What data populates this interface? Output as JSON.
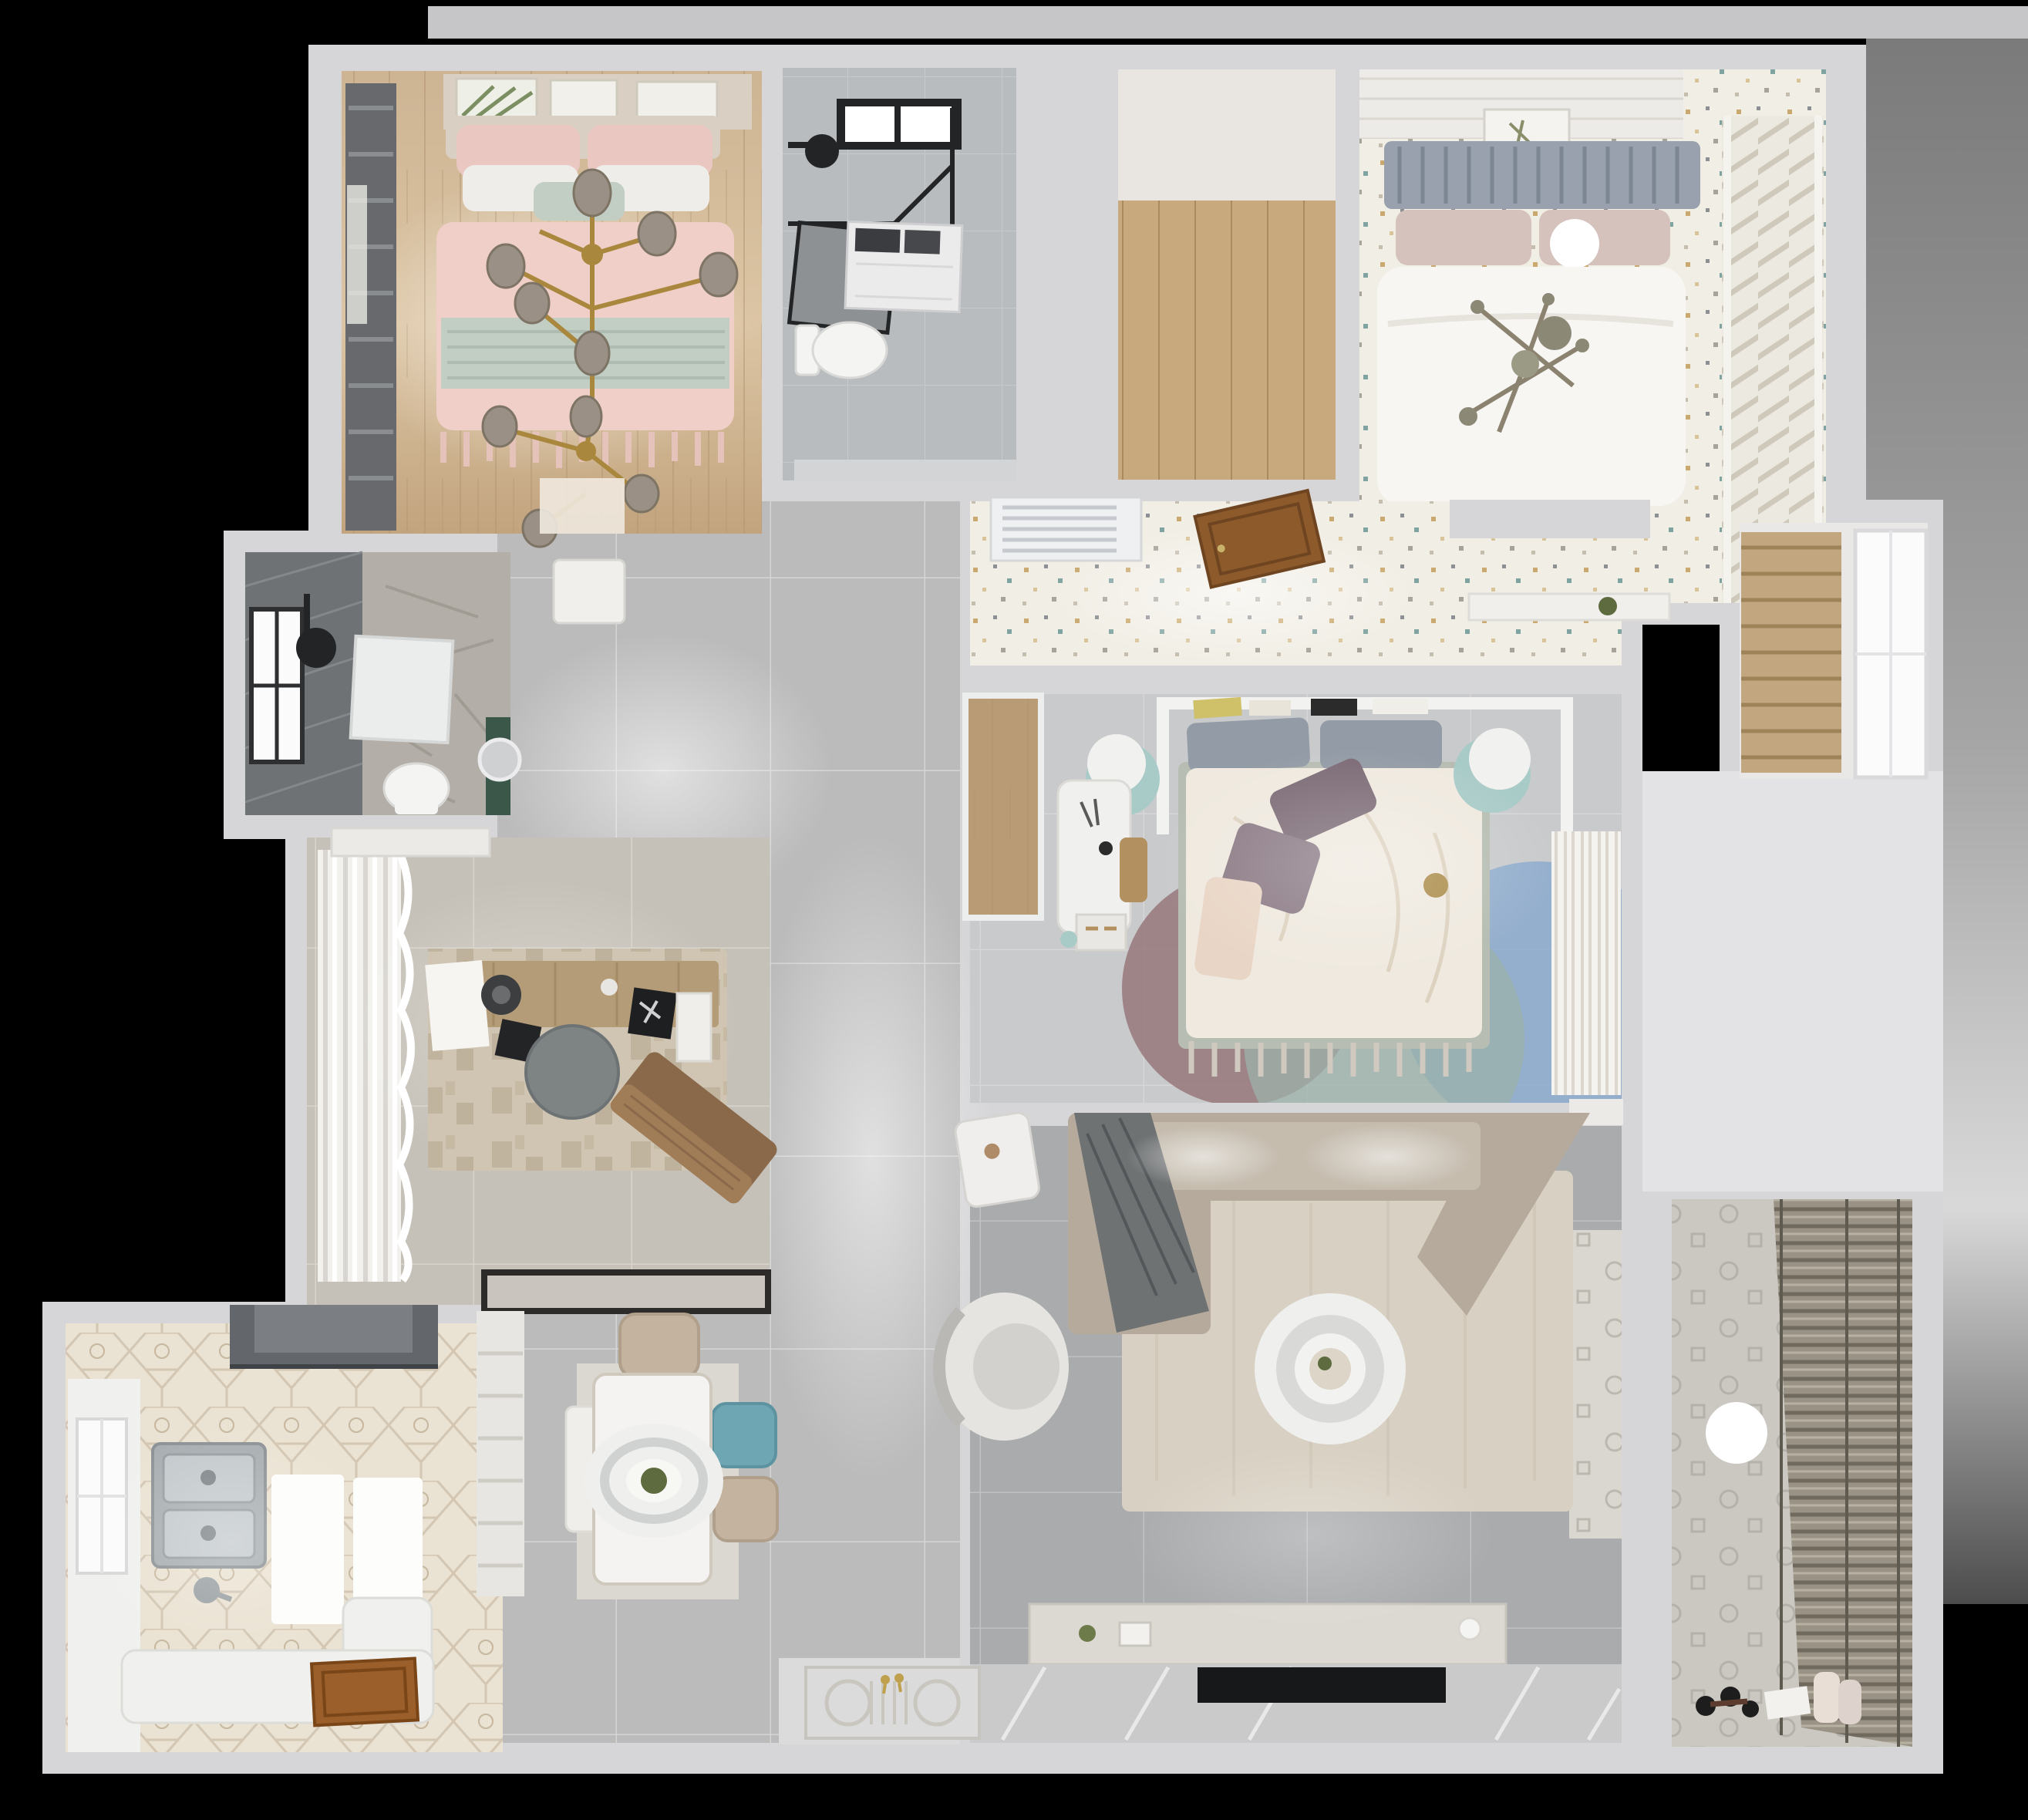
{
  "scene": {
    "type": "3d-floorplan-top-down-render",
    "rooms": [
      {
        "id": "bedroom-pink",
        "label": "bedroom-with-pink-bed"
      },
      {
        "id": "bathroom-top",
        "label": "bathroom-with-shower-and-washer"
      },
      {
        "id": "closet-room",
        "label": "empty-room-wood-floor"
      },
      {
        "id": "bedroom-white",
        "label": "bedroom-with-white-bed"
      },
      {
        "id": "dressing-corridor",
        "label": "corridor-with-ac-vent-and-open-door"
      },
      {
        "id": "master-bedroom",
        "label": "bedroom-with-desk-and-round-rug"
      },
      {
        "id": "bathroom-small",
        "label": "small-shower-room"
      },
      {
        "id": "study",
        "label": "study-with-desk-and-lounge-chair"
      },
      {
        "id": "kitchen",
        "label": "kitchen-hexagon-tile"
      },
      {
        "id": "dining",
        "label": "dining-area-with-pendant"
      },
      {
        "id": "living",
        "label": "living-room-with-sectional-sofa"
      },
      {
        "id": "bathroom-balcony",
        "label": "utility-room-with-blinds"
      },
      {
        "id": "closet-niche",
        "label": "shelf-niche-with-window"
      },
      {
        "id": "hallway",
        "label": "central-hallway"
      }
    ]
  },
  "palette": {
    "background": "#000000",
    "wall": "#d6d6d9",
    "wallLight": "#e3e3e6",
    "topStrip": "#c6c6c9",
    "hallFloor": "#babbba",
    "entryFloor": "#dadbda",
    "bedroom1Floor": "#d3bb98",
    "curtainDark": "#67696c",
    "pillowPink": "#eac7c1",
    "pillowWhite": "#efede9",
    "duvetPink": "#f0cfc8",
    "duvetSage": "#c2cec4",
    "headboard1": "#d9d0c3",
    "gold": "#a9873d",
    "bulbGlass": "#9a9085",
    "bath1Floor": "#b9bcbe",
    "fixtureBlack": "#222426",
    "washerWhite": "#ebebec",
    "toiletWhite": "#f4f4f2",
    "closetCeiling": "#e9e6e2",
    "closetWood": "#c8a87d",
    "bedroom2Floor": "#f1eee5",
    "speckTan": "#c9a96d",
    "speckTeal": "#7fa3a0",
    "speckGray": "#8c8f93",
    "ceilingPlank": "#edebe7",
    "headboard2": "#98a1ad",
    "pillowBlush": "#d6c2bc",
    "duvet2": "#f7f6f3",
    "wardrobeSlat": "#ece9e1",
    "ventWhite": "#eff0f1",
    "doorWood": "#8d5a2b",
    "masterFloor": "#c9cacc",
    "canopyWhite": "#f2f2f0",
    "pillowGray2": "#939ba6",
    "duvetCream": "#efe9df",
    "pillowPurple": "#7c6b76",
    "pillowPeach": "#e9d5c5",
    "nightstandTeal": "#a9cbc8",
    "deskWhite": "#f0f0ef",
    "stoolWood": "#b3905f",
    "masterClosetWood": "#b99b76",
    "clothesWhite": "#f4f3ef",
    "rugBlue": "#87a7cd",
    "rugMauve": "#937076",
    "rugSage": "#9cb1a9",
    "sbDarkTile": "#6f7275",
    "sbMarble": "#b3afa8",
    "sbGreen": "#3a574a",
    "trayWhite": "#ebecec",
    "studyFloor": "#c6c1b8",
    "studyRug": "#cfc5b2",
    "curtainWhite": "#f2f1ee",
    "deskWood": "#b59c78",
    "chairGray": "#7e8384",
    "loungeTan": "#8a684a",
    "matLight": "#c9c5be",
    "kitchenFloor": "#eae2d2",
    "hoodDark": "#63676b",
    "counterWhite": "#f0f0ee",
    "windowWhite": "#fbfbfb",
    "sinkSteel": "#a7adb0",
    "boardBright": "#fdfdfc",
    "kdoorWood": "#9a5f2a",
    "paleDining": "#dad8d1",
    "tableWhite": "#f4f3f1",
    "chairTan": "#c4b39e",
    "chairTeal": "#6fa6b4",
    "pendantWhite": "#eff0ee",
    "plantGreen": "#5d6b3f",
    "shelfWhite": "#e7e6e3",
    "livingFloor": "#a9abac",
    "livingRug": "#d8d0c2",
    "sofaBeige": "#b5aa9c",
    "blanketGray": "#6f7273",
    "coffeeWhite": "#eff0ee",
    "consoleGrey": "#dcd9d3",
    "tvBlack": "#17181a",
    "walkway": "#c9cac9",
    "bath2Floor": "#cbc8c2",
    "blindsBase": "#999285",
    "blindsLine": "#6f695e",
    "sphereWhite": "#ffffff",
    "shelfWoodM": "#c2a67f"
  }
}
